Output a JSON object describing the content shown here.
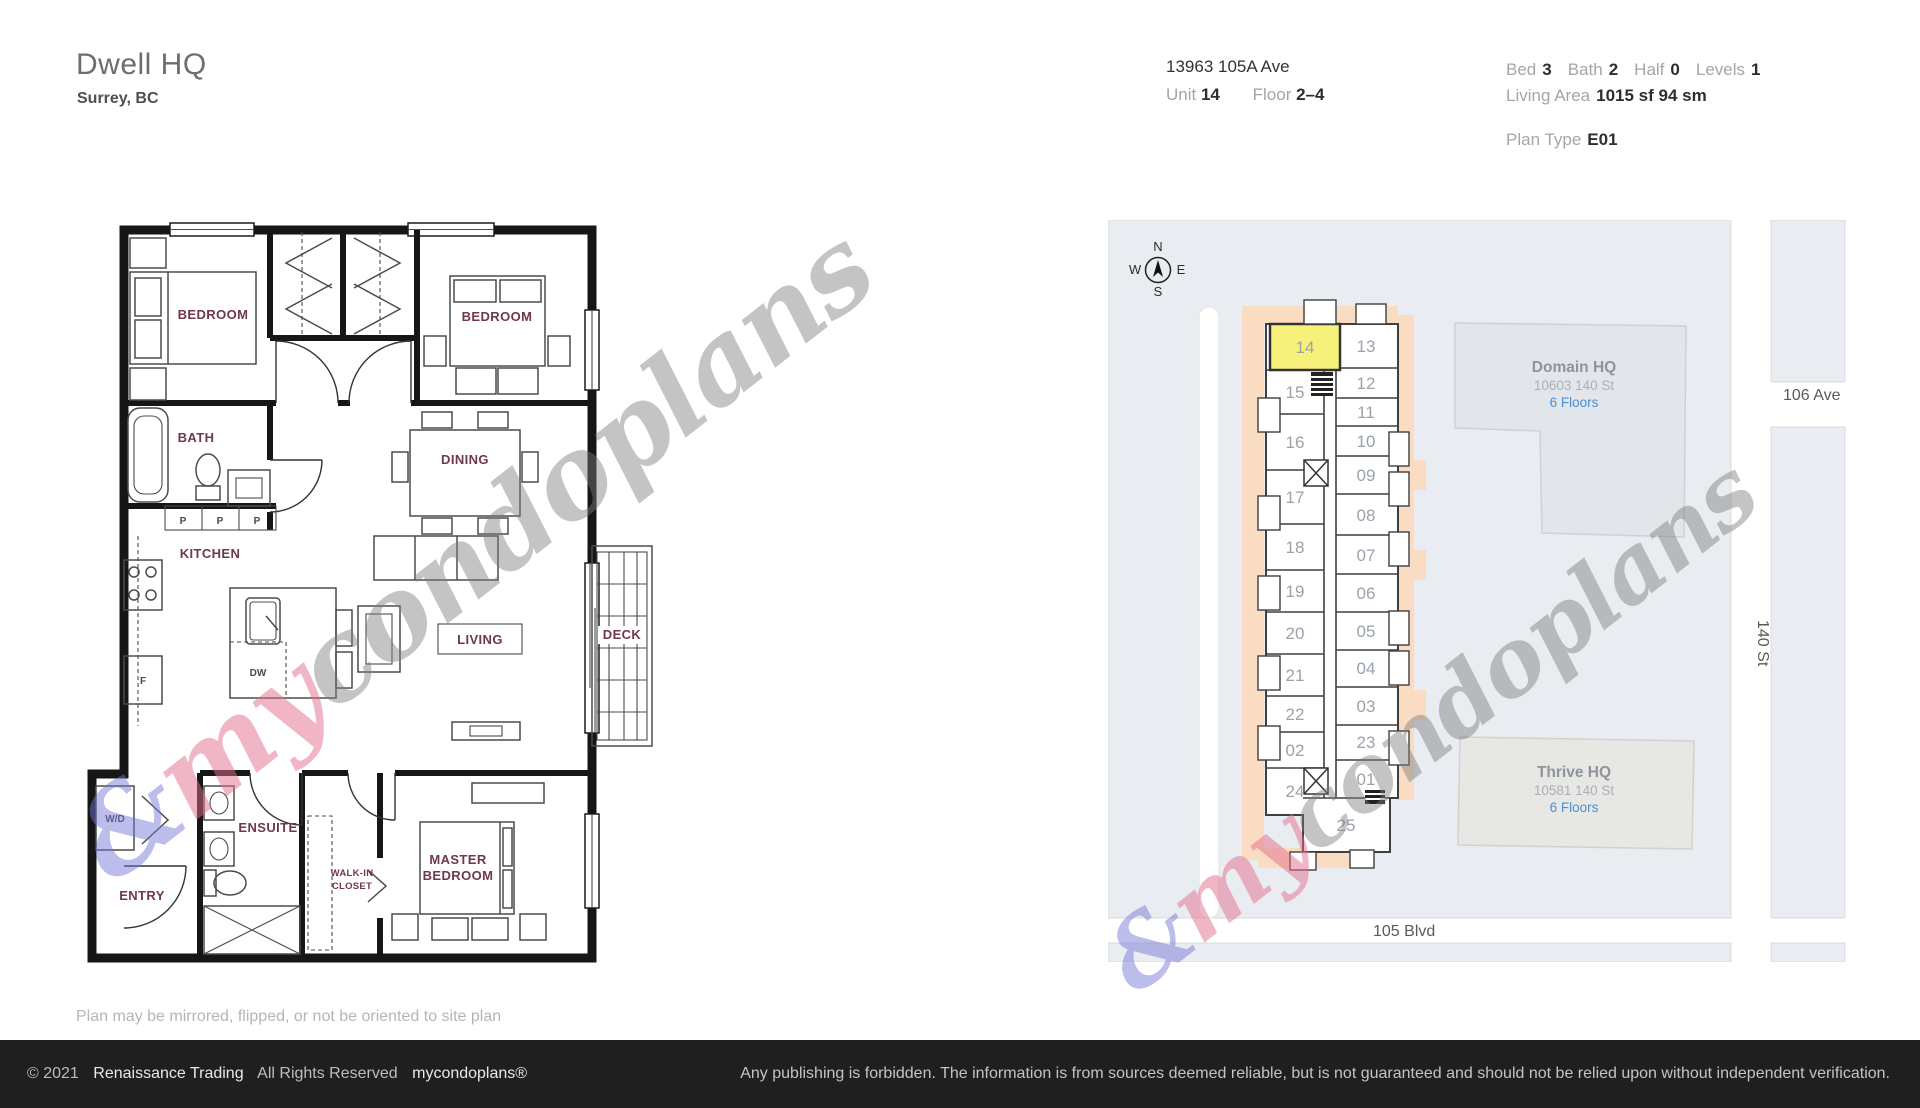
{
  "header": {
    "title": "Dwell HQ",
    "subtitle": "Surrey, BC"
  },
  "address": {
    "street": "13963 105A Ave",
    "unit_label": "Unit",
    "unit": "14",
    "floor_label": "Floor",
    "floor": "2–4"
  },
  "details": {
    "bed_label": "Bed",
    "bed": "3",
    "bath_label": "Bath",
    "bath": "2",
    "half_label": "Half",
    "half": "0",
    "levels_label": "Levels",
    "levels": "1",
    "living_area_label": "Living Area",
    "living_area": "1015 sf 94 sm",
    "plan_type_label": "Plan Type",
    "plan_type": "E01"
  },
  "floorplan": {
    "rooms": {
      "bedroom1": "BEDROOM",
      "bedroom2": "BEDROOM",
      "bath": "BATH",
      "dining": "DINING",
      "kitchen": "KITCHEN",
      "living": "LIVING",
      "deck": "DECK",
      "entry": "ENTRY",
      "ensuite": "ENSUITE",
      "walkin_line1": "WALK-IN",
      "walkin_line2": "CLOSET",
      "master_line1": "MASTER",
      "master_line2": "BEDROOM",
      "wd": "W/D",
      "dw": "DW",
      "fridge": "F",
      "pantry": "P"
    },
    "disclaimer": "Plan may be mirrored, flipped, or not be oriented to site plan"
  },
  "siteplan": {
    "compass": {
      "n": "N",
      "e": "E",
      "s": "S",
      "w": "W"
    },
    "highlighted_unit": "14",
    "unit_numbers": [
      "01",
      "02",
      "03",
      "04",
      "05",
      "06",
      "07",
      "08",
      "09",
      "10",
      "11",
      "12",
      "13",
      "14",
      "15",
      "16",
      "17",
      "18",
      "19",
      "20",
      "21",
      "22",
      "23",
      "24",
      "25"
    ],
    "buildings": [
      {
        "name": "Domain HQ",
        "address": "10603 140 St",
        "floors": "6 Floors"
      },
      {
        "name": "Thrive HQ",
        "address": "10581 140 St",
        "floors": "6 Floors"
      }
    ],
    "streets": {
      "ave106": "106 Ave",
      "st140": "140 St",
      "blvd105": "105 Blvd"
    },
    "colors": {
      "highlight": "#f6f17b",
      "balcony": "#f9dcc2",
      "floors_link": "#4a90d2"
    }
  },
  "watermark": {
    "amp": "&",
    "my": "my",
    "rest": "condoplans"
  },
  "footer": {
    "copyright": "© 2021",
    "company": "Renaissance Trading",
    "rights": "All Rights Reserved",
    "brand": "mycondoplans®",
    "notice": "Any publishing is forbidden.  The information is from sources deemed reliable, but is not guaranteed and should not be relied upon without independent verification."
  }
}
